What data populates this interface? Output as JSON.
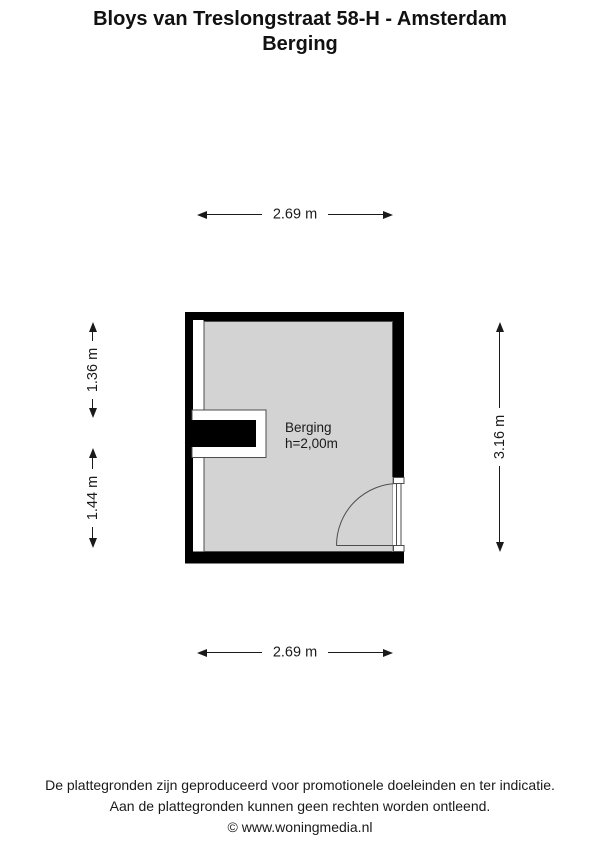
{
  "title": {
    "line1": "Bloys van Treslongstraat 58-H - Amsterdam",
    "line2": "Berging"
  },
  "floorplan": {
    "room": {
      "name": "Berging",
      "ceiling_height": "h=2,00m"
    },
    "dimensions": {
      "top": "2.69 m",
      "bottom": "2.69 m",
      "left_upper": "1.36 m",
      "left_lower": "1.44 m",
      "right": "3.16 m"
    },
    "colors": {
      "wall": "#000000",
      "floor": "#d3d3d3",
      "outline": "#4d4d4d",
      "opening": "#ffffff",
      "text": "#1a1a1a"
    },
    "icons": {
      "dimension_arrow": "css-triangle"
    }
  },
  "footer": {
    "line1": "De plattegronden zijn geproduceerd voor promotionele doeleinden en ter indicatie.",
    "line2": "Aan de plattegronden kunnen geen rechten worden ontleend.",
    "line3": "© www.woningmedia.nl"
  }
}
